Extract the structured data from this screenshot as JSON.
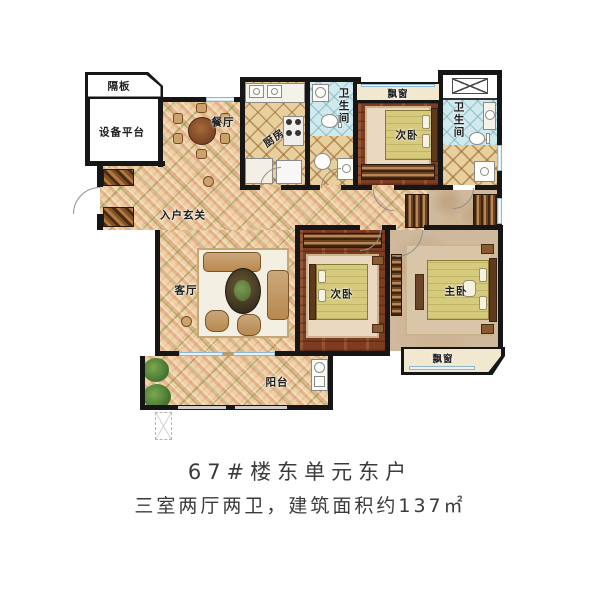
{
  "plan": {
    "rooms": [
      {
        "id": "partition",
        "label": "隔板"
      },
      {
        "id": "equipment-platform",
        "label": "设备平台"
      },
      {
        "id": "dining",
        "label": "餐厅"
      },
      {
        "id": "kitchen",
        "label": "厨房"
      },
      {
        "id": "bath-top",
        "label": "卫生间"
      },
      {
        "id": "bay-window-top",
        "label": "飘窗"
      },
      {
        "id": "bedroom-top",
        "label": "次卧"
      },
      {
        "id": "bath-right",
        "label": "卫生间"
      },
      {
        "id": "entry-hall",
        "label": "入户玄关"
      },
      {
        "id": "living",
        "label": "客厅"
      },
      {
        "id": "bedroom-mid",
        "label": "次卧"
      },
      {
        "id": "master-bedroom",
        "label": "主卧"
      },
      {
        "id": "bay-window-master",
        "label": "飘窗"
      },
      {
        "id": "balcony",
        "label": "阳台"
      }
    ],
    "icons": [
      "dining-table-icon",
      "sofa-icon",
      "coffee-table-icon",
      "bed-icon",
      "toilet-icon",
      "sink-icon",
      "washer-icon",
      "stove-icon",
      "shower-icon",
      "plant-icon",
      "wardrobe-icon",
      "shaft-x-icon",
      "door-arc-icon",
      "scale-marker-icon"
    ]
  },
  "caption": {
    "line1": "67#楼东单元东户",
    "line2": "三室两厅两卫，建筑面积约137㎡"
  },
  "colors": {
    "wall": "#161616",
    "tile_floor": "#eed2a6",
    "wood_floor": "#7e3d22",
    "marble_floor": "#cfb99c",
    "lattice_floor": "#e7cf9e",
    "bath_tile": "#cfe9ec",
    "window": "#cfe4f1",
    "bed": "#d6ca7c",
    "sofa": "#b9894f",
    "plant": "#4c7a36",
    "caption_text": "#3b3b3b"
  }
}
